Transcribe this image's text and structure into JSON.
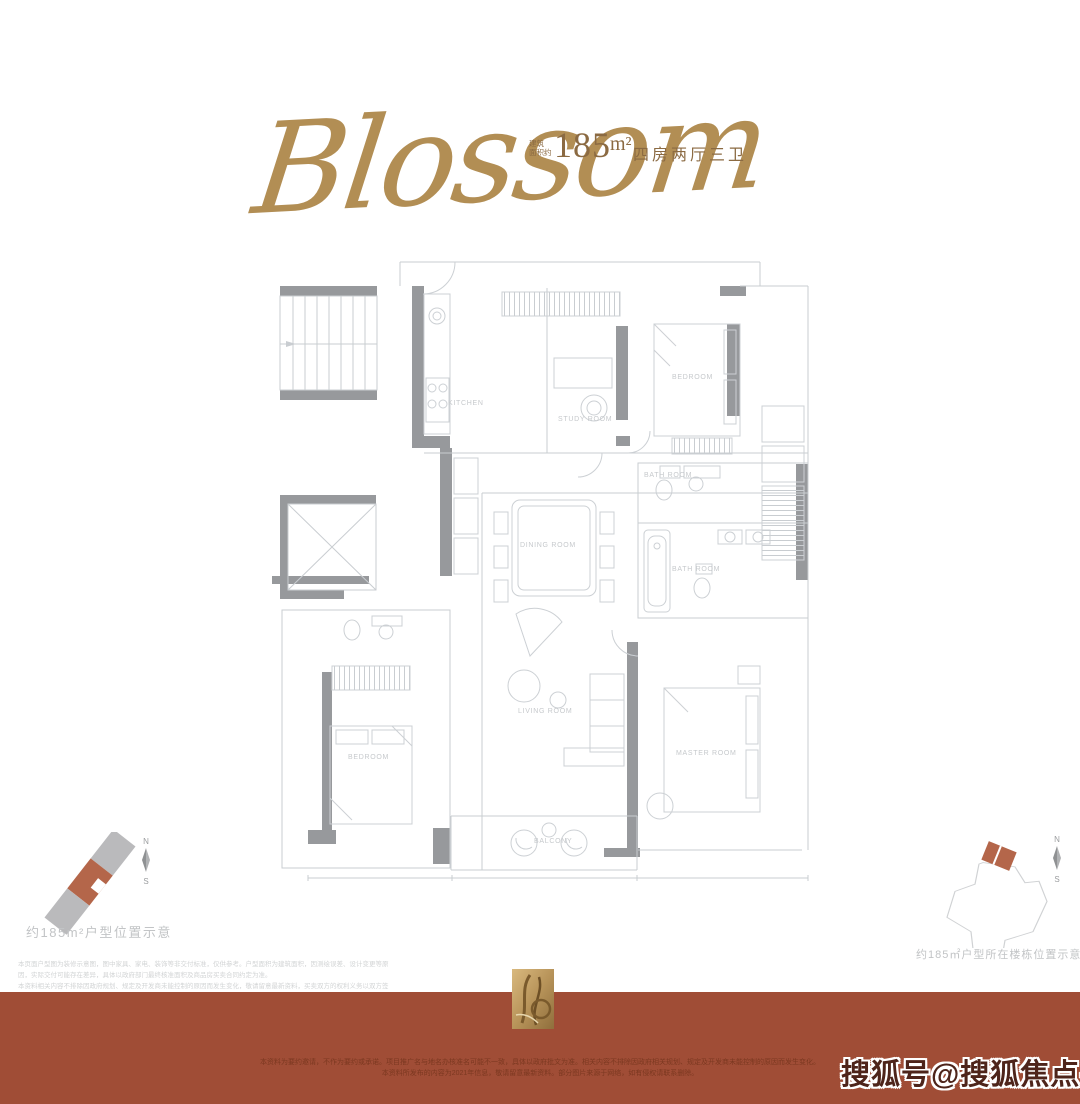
{
  "colors": {
    "gold": "#b28e54",
    "bronze": "#8b6a42",
    "terracotta": "#a04d36",
    "footer_text": "#7b3820",
    "highlight": "#b4664a",
    "plan_wall": "#97999c",
    "plan_line": "#c9cdd1",
    "label_gray": "#c6c9cc",
    "caption_gray": "#c2c4c6",
    "watermark": "#4e241a"
  },
  "header": {
    "script_title": "Blossom",
    "area_prefix_line1": "建筑",
    "area_prefix_line2": "面积约",
    "area_value": "185",
    "area_unit": "m²",
    "layout_text": "四房两厅三卫"
  },
  "floor_plan": {
    "room_labels": [
      {
        "text": "KITCHEN"
      },
      {
        "text": "STUDY ROOM"
      },
      {
        "text": "BEDROOM"
      },
      {
        "text": "BATH ROOM"
      },
      {
        "text": "DINING ROOM"
      },
      {
        "text": "BATH ROOM"
      },
      {
        "text": "LIVING ROOM"
      },
      {
        "text": "BEDROOM"
      },
      {
        "text": "MASTER ROOM"
      },
      {
        "text": "BALCONY"
      }
    ]
  },
  "left_diagram": {
    "compass_north": "N",
    "compass_south": "S",
    "caption": "约185m²户型位置示意"
  },
  "right_diagram": {
    "compass_north": "N",
    "compass_south": "S",
    "caption": "约185㎡户型所在楼栋位置示意图"
  },
  "disclaimer": {
    "line1": "本页面户型图为装修示意图，图中家具、家电、装饰等非交付标准，仅供参考。户型面积为建筑面积，因测绘误差、设计变更等原因，实际交付可能存在差异，具体以政府部门最终核准面积及商品房买卖合同约定为准。",
    "line2": "本资料相关内容不排除因政府规划、规定及开发商未能控制的原因而发生变化，敬请留意最新资料，买卖双方的权利义务以双方签订的商品房买卖合同及其附件为准。"
  },
  "footer": {
    "line1": "本资料为要约邀请，不作为要约或承诺。项目推广名与地名办核准名可能不一致，具体以政府批文为准。相关内容不排除因政府相关规划、规定及开发商未能控制的原因而发生变化。",
    "line2": "本资料所发布的内容为2021年信息，敬请留意最新资料。部分图片来源于网络，如有侵权请联系删除。",
    "watermark": "搜狐号@搜狐焦点宿州站"
  }
}
